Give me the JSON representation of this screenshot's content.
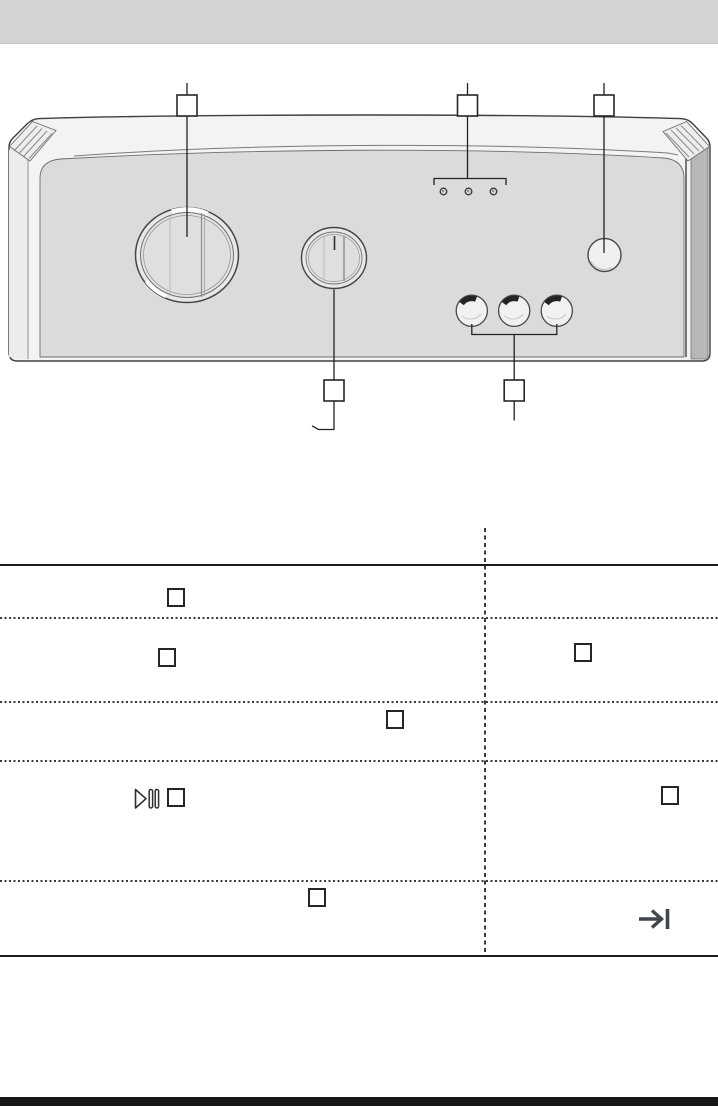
{
  "page": {
    "kind": "appliance-manual-control-panel-page",
    "background_color": "#ffffff",
    "header_band_color": "#d2d3d5",
    "footer_bar_color": "#161616",
    "visible_text": ""
  },
  "diagram": {
    "name": "control-panel-illustration",
    "panel_colors": {
      "top_surface": "#f3f3f4",
      "front_face": "#dadbdd",
      "right_side_strip": "#b5b7b9",
      "outline": "#3f3f3f",
      "leader_line": "#222222"
    },
    "callouts": [
      {
        "name": "callout-box-1",
        "label": "",
        "position": "top-left",
        "points_to": "large-selector-knob"
      },
      {
        "name": "callout-box-2",
        "label": "",
        "position": "top-middle",
        "points_to": "indicator-lights"
      },
      {
        "name": "callout-box-3",
        "label": "",
        "position": "top-right",
        "points_to": "round-button"
      },
      {
        "name": "callout-box-4",
        "label": "",
        "position": "bottom-left",
        "points_to": "small-selector-knob"
      },
      {
        "name": "callout-box-5",
        "label": "",
        "position": "bottom-middle",
        "points_to": "option-buttons"
      }
    ],
    "controls": [
      {
        "name": "large-selector-knob",
        "type": "rotary-knob"
      },
      {
        "name": "small-selector-knob",
        "type": "rotary-knob",
        "has_position_mark": true
      },
      {
        "name": "indicator-lights",
        "type": "led-row",
        "count": 3
      },
      {
        "name": "round-button",
        "type": "push-button"
      },
      {
        "name": "option-buttons",
        "type": "push-button-row",
        "count": 3
      }
    ]
  },
  "table": {
    "columns": 2,
    "column_divider_style": "dashed-vertical",
    "row_divider_style": "dotted-horizontal",
    "outer_border_style": "solid-top-and-bottom",
    "rows": [
      {
        "left_icons": [
          "empty-box-icon"
        ],
        "right_icons": []
      },
      {
        "left_icons": [
          "empty-box-icon"
        ],
        "right_icons": [
          "empty-box-icon"
        ]
      },
      {
        "left_icons": [
          "empty-box-icon"
        ],
        "right_icons": []
      },
      {
        "left_icons": [
          "play-pause-icon",
          "empty-box-icon"
        ],
        "right_icons": [
          "empty-box-icon"
        ]
      },
      {
        "left_icons": [
          "empty-box-icon"
        ],
        "right_icons": [
          "skip-to-end-icon"
        ]
      }
    ]
  }
}
